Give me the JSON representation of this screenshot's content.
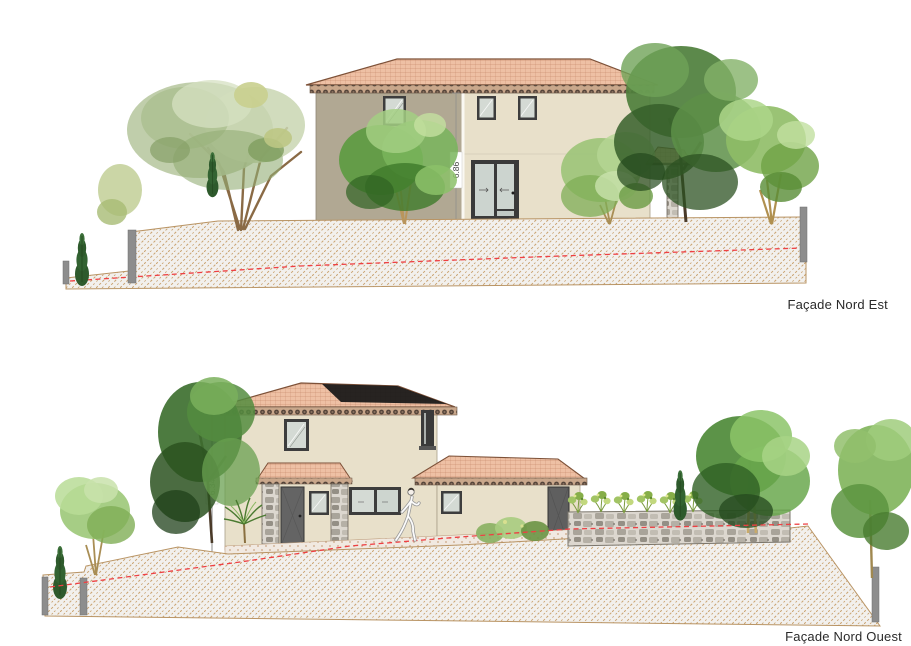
{
  "drawing": {
    "sheet_background": "#ffffff",
    "panels": [
      {
        "id": "facade-nord-est",
        "label": "Façade Nord Est",
        "dimension": "6.86"
      },
      {
        "id": "facade-nord-ouest",
        "label": "Façade Nord Ouest",
        "dimension": "6.34"
      }
    ]
  },
  "palette": {
    "wall_beige": "#e8e0ca",
    "wall_taupe": "#b1a893",
    "roof_salmon": "#eec0a4",
    "roof_line": "#c5886a",
    "frieze_dark": "#55453a",
    "frame_dark": "#3d3d3d",
    "door_gray": "#666666",
    "glass": "#d4dad4",
    "terrain_hatch_tan": "#c9a26e",
    "terrain_bg": "#f2f0ed",
    "ground_line_red": "#ee4043",
    "stone_gray": "#b5b0a6",
    "foliage_dark_green": "#3e7030",
    "foliage_mid_green": "#5c9a40",
    "foliage_light_green": "#9cc878",
    "foliage_sage": "#b9c9a2",
    "trunk_brown": "#8a6a45",
    "post_gray": "#8d8d8d"
  }
}
